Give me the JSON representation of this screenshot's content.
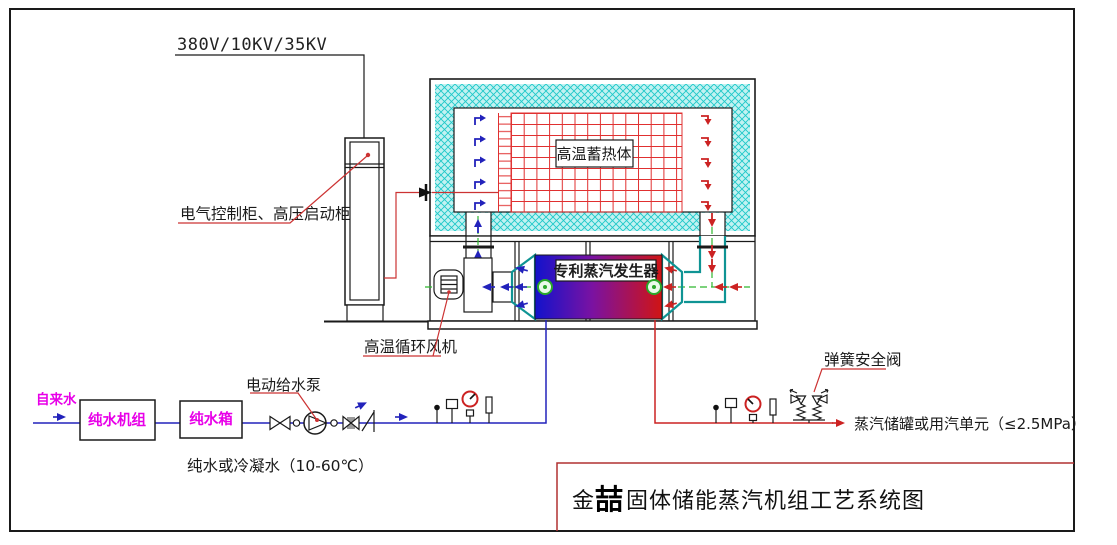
{
  "drawing": {
    "power_voltage": "380V/10KV/35KV",
    "cabinet_label": "电气控制柜、高压启动柜",
    "storage_label": "高温蓄热体",
    "generator_label": "专利蒸汽发生器",
    "fan_label": "高温循环风机",
    "water": {
      "tap_water": "自来水",
      "purifier": "纯水机组",
      "tank": "纯水箱",
      "pump": "电动给水泵",
      "condition": "纯水或冷凝水（10-60℃）"
    },
    "steam": {
      "safety_valve": "弹簧安全阀",
      "destination": "蒸汽储罐或用汽单元（≤2.5MPa）"
    },
    "title": {
      "brand_first": "金",
      "brand_second": "喆",
      "suffix": "固体储能蒸汽机组工艺系统图"
    },
    "colors": {
      "insulation_fill": "#c2f2f2",
      "insulation_hatch": "#1ec9c9",
      "heater_grid": "#e03030",
      "water_blue": "#2222bb",
      "steam_red": "#cc2222",
      "centerline_green": "#2eb82e",
      "label_magenta": "#e800e8",
      "leader_red": "#cc3333",
      "vessel_cold": "#1212cc",
      "vessel_mid": "#7a12a2",
      "vessel_hot": "#d01414",
      "duct_teal": "#0f9494"
    }
  }
}
